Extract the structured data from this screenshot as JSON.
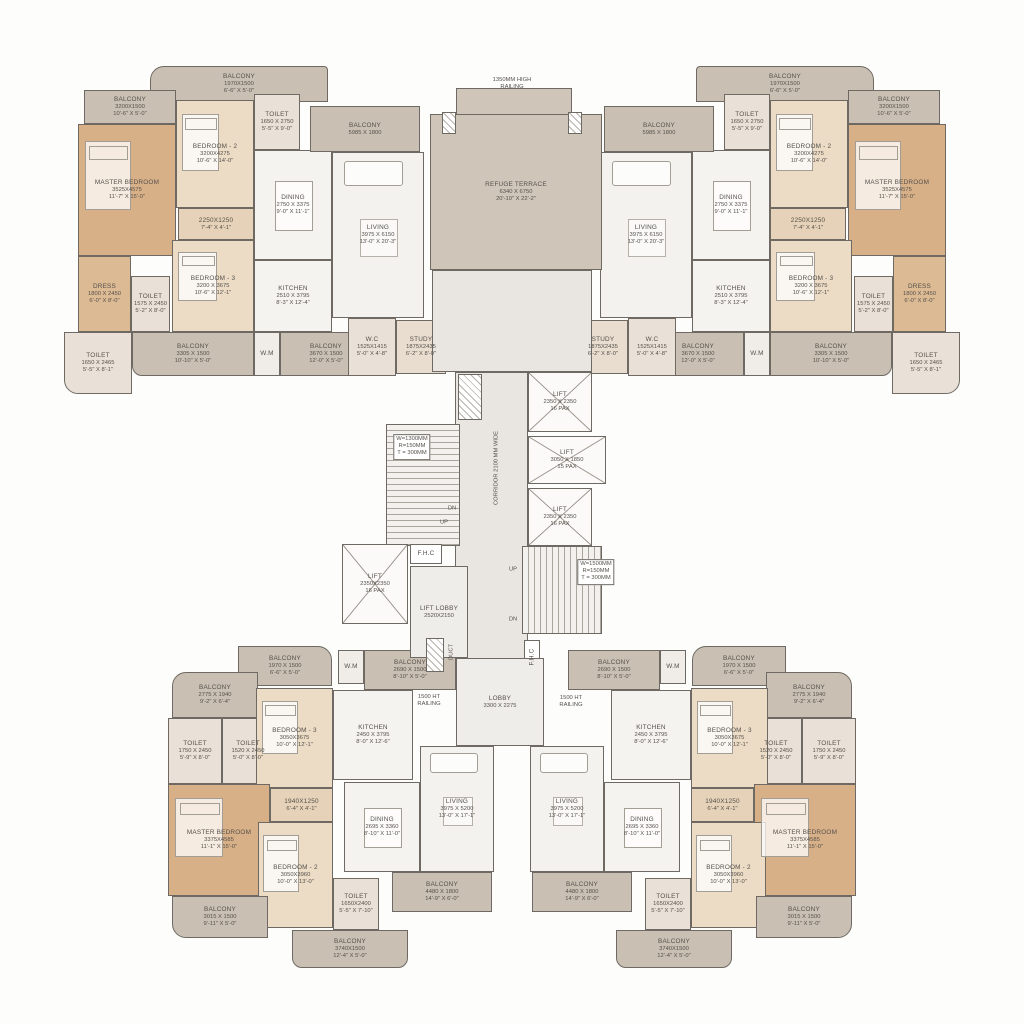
{
  "palette": {
    "wall": "#6e6a63",
    "balcony": "#c9bfb2",
    "terrace": "#cfc5b9",
    "bedroom": "#ecdcc6",
    "master": "#d8b088",
    "dress": "#dcba94",
    "passage": "#e6d2b8",
    "toilet": "#e9e1d7",
    "dining": "#f5f3ef",
    "kitchen": "#f5f3ef",
    "living": "#f4f2ee",
    "study": "#e9ddcf",
    "corridor": "#e9e6e1",
    "lobby": "#efede9",
    "lift": "#fbfaf8",
    "stair": "#f3f1ed",
    "stair2": "#f3f1ed",
    "wm": "#f0ede8",
    "duct": "#ffffff",
    "fhc": "#ffffff",
    "bg": "#fdfdfc"
  },
  "canvas": {
    "w": 1024,
    "h": 1024,
    "mirror_axis": 512
  },
  "instances": [
    {
      "unit": "top",
      "mirror": false,
      "name": "unit-top-left"
    },
    {
      "unit": "top",
      "mirror": true,
      "name": "unit-top-right"
    },
    {
      "unit": "bottom",
      "mirror": false,
      "name": "unit-bottom-left"
    },
    {
      "unit": "bottom",
      "mirror": true,
      "name": "unit-bottom-right"
    }
  ],
  "units": {
    "top": {
      "rooms": [
        {
          "id": "balcony-upper",
          "lines": [
            "BALCONY",
            "1970X1500",
            "6'-6\" X 5'-0\""
          ],
          "x": 150,
          "y": 66,
          "w": 178,
          "h": 36,
          "t": "balcony",
          "r": "14px 4px 0 0"
        },
        {
          "id": "balcony-master",
          "lines": [
            "BALCONY",
            "3200X1500",
            "10'-6\" X 5'-0\""
          ],
          "x": 84,
          "y": 90,
          "w": 92,
          "h": 34,
          "t": "balcony"
        },
        {
          "id": "toilet-bed2",
          "lines": [
            "TOILET",
            "1650 X 2750",
            "5'-5\" X 9'-0\""
          ],
          "x": 254,
          "y": 94,
          "w": 46,
          "h": 56,
          "t": "toilet"
        },
        {
          "id": "master-bedroom",
          "lines": [
            "MASTER BEDROOM",
            "3525X4575",
            "11'-7\" X 15'-0\""
          ],
          "x": 78,
          "y": 124,
          "w": 98,
          "h": 132,
          "t": "master"
        },
        {
          "id": "bedroom-2",
          "lines": [
            "BEDROOM - 2",
            "3200X4275",
            "10'-6\" X 14'-0\""
          ],
          "x": 176,
          "y": 100,
          "w": 78,
          "h": 108,
          "t": "bedroom"
        },
        {
          "id": "passage",
          "lines": [
            "2250X1250",
            "7'-4\" X 4'-1\""
          ],
          "x": 178,
          "y": 208,
          "w": 76,
          "h": 32,
          "t": "passage"
        },
        {
          "id": "bedroom-3",
          "lines": [
            "BEDROOM - 3",
            "3200 X 3675",
            "10'-6\" X 12'-1\""
          ],
          "x": 172,
          "y": 240,
          "w": 82,
          "h": 92,
          "t": "bedroom"
        },
        {
          "id": "dress",
          "lines": [
            "DRESS",
            "1800 X 2450",
            "6'-0\" X 8'-0\""
          ],
          "x": 78,
          "y": 256,
          "w": 53,
          "h": 76,
          "t": "dress"
        },
        {
          "id": "toilet-master",
          "lines": [
            "TOILET",
            "1575 X 2450",
            "5'-2\" X 8'-0\""
          ],
          "x": 131,
          "y": 276,
          "w": 39,
          "h": 56,
          "t": "toilet"
        },
        {
          "id": "toilet-bed3",
          "lines": [
            "TOILET",
            "1650 X 2465",
            "5'-5\" X 8'-1\""
          ],
          "x": 64,
          "y": 332,
          "w": 68,
          "h": 62,
          "t": "toilet",
          "r": "0 0 0 14px"
        },
        {
          "id": "balcony-bed3",
          "lines": [
            "BALCONY",
            "3305 X 1500",
            "10'-10\" X 5'-0\""
          ],
          "x": 132,
          "y": 332,
          "w": 122,
          "h": 44,
          "t": "balcony",
          "r": "0 0 0 10px"
        },
        {
          "id": "wm",
          "lines": [
            "W.M"
          ],
          "x": 254,
          "y": 332,
          "w": 26,
          "h": 44,
          "t": "wm"
        },
        {
          "id": "balcony-kitchen",
          "lines": [
            "BALCONY",
            "3670 X 1500",
            "12'-0\" X 5'-0\""
          ],
          "x": 280,
          "y": 332,
          "w": 92,
          "h": 44,
          "t": "balcony"
        },
        {
          "id": "dining",
          "lines": [
            "DINING",
            "2750 X 3375",
            "9'-0\" X 11'-1\""
          ],
          "x": 254,
          "y": 150,
          "w": 78,
          "h": 110,
          "t": "dining"
        },
        {
          "id": "kitchen",
          "lines": [
            "KITCHEN",
            "2510 X 3795",
            "8'-3\" X 12'-4\""
          ],
          "x": 254,
          "y": 260,
          "w": 78,
          "h": 72,
          "t": "kitchen"
        },
        {
          "id": "living",
          "lines": [
            "LIVING",
            "3975 X 6150",
            "13'-0\" X 20'-3\""
          ],
          "x": 332,
          "y": 152,
          "w": 92,
          "h": 166,
          "t": "living"
        },
        {
          "id": "balcony-living",
          "lines": [
            "BALCONY",
            "5985 X 1800"
          ],
          "x": 310,
          "y": 106,
          "w": 110,
          "h": 46,
          "t": "balcony"
        },
        {
          "id": "study",
          "lines": [
            "STUDY",
            "1875X2435",
            "6'-2\" X 8'-0\""
          ],
          "x": 396,
          "y": 320,
          "w": 50,
          "h": 54,
          "t": "study"
        },
        {
          "id": "wc",
          "lines": [
            "W.C",
            "1525X1415",
            "5'-0\" X 4'-8\""
          ],
          "x": 348,
          "y": 318,
          "w": 48,
          "h": 58,
          "t": "toilet"
        }
      ]
    },
    "bottom": {
      "rooms": [
        {
          "id": "wm",
          "lines": [
            "W.M"
          ],
          "x": 338,
          "y": 650,
          "w": 26,
          "h": 34,
          "t": "wm"
        },
        {
          "id": "balcony-kitchen",
          "lines": [
            "BALCONY",
            "2690 X 1500",
            "8'-10\" X 5'-0\""
          ],
          "x": 364,
          "y": 650,
          "w": 92,
          "h": 40,
          "t": "balcony"
        },
        {
          "id": "balcony-upper",
          "lines": [
            "BALCONY",
            "1970 X 1500",
            "6'-6\" X 5'-0\""
          ],
          "x": 238,
          "y": 646,
          "w": 94,
          "h": 40,
          "t": "balcony",
          "r": "0 14px 0 0"
        },
        {
          "id": "balcony-side",
          "lines": [
            "BALCONY",
            "2775 X 1940",
            "9'-2\" X 6'-4\""
          ],
          "x": 172,
          "y": 672,
          "w": 86,
          "h": 46,
          "t": "balcony",
          "r": "14px 0 0 0"
        },
        {
          "id": "toilet-1",
          "lines": [
            "TOILET",
            "1750 X 2450",
            "5'-9\" X 8'-0\""
          ],
          "x": 168,
          "y": 718,
          "w": 54,
          "h": 66,
          "t": "toilet"
        },
        {
          "id": "toilet-2",
          "lines": [
            "TOILET",
            "1520 X 2450",
            "5'-0\" X 8'-0\""
          ],
          "x": 222,
          "y": 718,
          "w": 52,
          "h": 66,
          "t": "toilet"
        },
        {
          "id": "bedroom-3",
          "lines": [
            "BEDROOM - 3",
            "3050X3675",
            "10'-0\" X 12'-1\""
          ],
          "x": 256,
          "y": 688,
          "w": 77,
          "h": 100,
          "t": "bedroom"
        },
        {
          "id": "kitchen",
          "lines": [
            "KITCHEN",
            "2450 X 3795",
            "8'-0\" X 12'-6\""
          ],
          "x": 333,
          "y": 690,
          "w": 80,
          "h": 90,
          "t": "kitchen"
        },
        {
          "id": "master-bedroom",
          "lines": [
            "MASTER BEDROOM",
            "3375X4585",
            "11'-1\" X 15'-0\""
          ],
          "x": 168,
          "y": 784,
          "w": 102,
          "h": 112,
          "t": "master"
        },
        {
          "id": "passage",
          "lines": [
            "1940X1250",
            "6'-4\" X 4'-1\""
          ],
          "x": 270,
          "y": 788,
          "w": 63,
          "h": 34,
          "t": "passage"
        },
        {
          "id": "bedroom-2",
          "lines": [
            "BEDROOM - 2",
            "3050X3960",
            "10'-0\" X 13'-0\""
          ],
          "x": 258,
          "y": 822,
          "w": 75,
          "h": 106,
          "t": "bedroom"
        },
        {
          "id": "dining",
          "lines": [
            "DINING",
            "2695 X 3360",
            "8'-10\" X 11'-0\""
          ],
          "x": 344,
          "y": 782,
          "w": 76,
          "h": 90,
          "t": "dining"
        },
        {
          "id": "living",
          "lines": [
            "LIVING",
            "3975 X 5200",
            "13'-0\" X 17'-1\""
          ],
          "x": 420,
          "y": 746,
          "w": 74,
          "h": 126,
          "t": "living"
        },
        {
          "id": "balcony-living",
          "lines": [
            "BALCONY",
            "4480 X 1800",
            "14'-9\" X 6'-0\""
          ],
          "x": 392,
          "y": 872,
          "w": 100,
          "h": 40,
          "t": "balcony"
        },
        {
          "id": "balcony-master",
          "lines": [
            "BALCONY",
            "3015 X 1500",
            "9'-11\" X 5'-0\""
          ],
          "x": 172,
          "y": 896,
          "w": 96,
          "h": 42,
          "t": "balcony",
          "r": "0 0 0 14px"
        },
        {
          "id": "toilet-3",
          "lines": [
            "TOILET",
            "1650X2400",
            "5'-5\" X 7'-10\""
          ],
          "x": 333,
          "y": 878,
          "w": 46,
          "h": 52,
          "t": "toilet"
        },
        {
          "id": "balcony-bed2",
          "lines": [
            "BALCONY",
            "3740X1500",
            "12'-4\" X 5'-0\""
          ],
          "x": 292,
          "y": 930,
          "w": 116,
          "h": 38,
          "t": "balcony",
          "r": "0 0 10px 10px"
        }
      ]
    }
  },
  "core": {
    "rooms": [
      {
        "id": "terrace-notch",
        "lines": [],
        "x": 456,
        "y": 88,
        "w": 116,
        "h": 28,
        "t": "terrace"
      },
      {
        "id": "refuge-terrace",
        "lines": [
          "REFUGE TERRACE",
          "6340 X 6750",
          "20'-10\" X 22'-2\""
        ],
        "x": 430,
        "y": 114,
        "w": 172,
        "h": 156,
        "t": "terrace"
      },
      {
        "id": "duct-terrace-left",
        "lines": [],
        "x": 442,
        "y": 112,
        "w": 14,
        "h": 22,
        "t": "duct"
      },
      {
        "id": "duct-terrace-right",
        "lines": [],
        "x": 568,
        "y": 112,
        "w": 14,
        "h": 22,
        "t": "duct"
      },
      {
        "id": "corridor-upper",
        "lines": [],
        "x": 432,
        "y": 270,
        "w": 160,
        "h": 102,
        "t": "corridor"
      },
      {
        "id": "corridor",
        "lines": [],
        "x": 455,
        "y": 372,
        "w": 73,
        "h": 288,
        "t": "corridor"
      },
      {
        "id": "shaft",
        "lines": [],
        "x": 458,
        "y": 374,
        "w": 24,
        "h": 46,
        "t": "duct"
      },
      {
        "id": "lift-1",
        "lines": [
          "LIFT",
          "2350 X 2350",
          "16 PAX"
        ],
        "x": 528,
        "y": 372,
        "w": 64,
        "h": 60,
        "t": "lift",
        "cross": true
      },
      {
        "id": "lift-2",
        "lines": [
          "LIFT",
          "3050 X 1850",
          "15 PAX"
        ],
        "x": 528,
        "y": 436,
        "w": 78,
        "h": 48,
        "t": "lift",
        "cross": true
      },
      {
        "id": "lift-3",
        "lines": [
          "LIFT",
          "2350 X 2350",
          "16 PAX"
        ],
        "x": 528,
        "y": 488,
        "w": 64,
        "h": 58,
        "t": "lift",
        "cross": true
      },
      {
        "id": "staircase-1",
        "lines": [],
        "x": 386,
        "y": 424,
        "w": 74,
        "h": 122,
        "t": "stair"
      },
      {
        "id": "lift-4",
        "lines": [
          "LIFT",
          "2350X2350",
          "16 PAX"
        ],
        "x": 342,
        "y": 544,
        "w": 66,
        "h": 80,
        "t": "lift",
        "cross": true
      },
      {
        "id": "fhc-1",
        "lines": [
          "F.H.C"
        ],
        "x": 410,
        "y": 544,
        "w": 32,
        "h": 20,
        "t": "fhc"
      },
      {
        "id": "lift-lobby",
        "lines": [
          "LIFT LOBBY",
          "2520X2150"
        ],
        "x": 410,
        "y": 566,
        "w": 58,
        "h": 92,
        "t": "lobby"
      },
      {
        "id": "staircase-2",
        "lines": [],
        "x": 522,
        "y": 546,
        "w": 80,
        "h": 88,
        "t": "stair2"
      },
      {
        "id": "fhc-2",
        "lines": [
          "F.H.C"
        ],
        "x": 524,
        "y": 640,
        "w": 16,
        "h": 34,
        "t": "fhc",
        "vert": true
      },
      {
        "id": "duct-lobby",
        "lines": [],
        "x": 426,
        "y": 638,
        "w": 18,
        "h": 34,
        "t": "duct"
      },
      {
        "id": "lobby",
        "lines": [
          "LOBBY",
          "3300 X 2275"
        ],
        "x": 456,
        "y": 658,
        "w": 88,
        "h": 88,
        "t": "lobby"
      }
    ]
  },
  "notes": [
    {
      "id": "railing-top",
      "text": "1350MM HIGH\nRAILING",
      "x": 512,
      "y": 84
    },
    {
      "id": "corridor-label",
      "text": "CORRIDOR 2100 MM WIDE",
      "x": 497,
      "y": 468,
      "rot": -90
    },
    {
      "id": "stair1-spec",
      "text": "W=1300MM\nR=150MM\nT = 300MM",
      "x": 412,
      "y": 447,
      "box": true
    },
    {
      "id": "stair2-spec",
      "text": "W=1500MM\nR=150MM\nT = 300MM",
      "x": 596,
      "y": 572,
      "box": true
    },
    {
      "id": "stair1-dn",
      "text": "DN",
      "x": 452,
      "y": 509
    },
    {
      "id": "stair1-up",
      "text": "UP",
      "x": 444,
      "y": 523
    },
    {
      "id": "stair2-up",
      "text": "UP",
      "x": 513,
      "y": 570
    },
    {
      "id": "stair2-dn",
      "text": "DN",
      "x": 513,
      "y": 620
    },
    {
      "id": "duct-label",
      "text": "DUCT",
      "x": 452,
      "y": 652,
      "rot": -90
    },
    {
      "id": "railing-left",
      "text": "1500 HT\nRAILING",
      "x": 429,
      "y": 701
    },
    {
      "id": "railing-right",
      "text": "1500 HT\nRAILING",
      "x": 571,
      "y": 702
    }
  ]
}
